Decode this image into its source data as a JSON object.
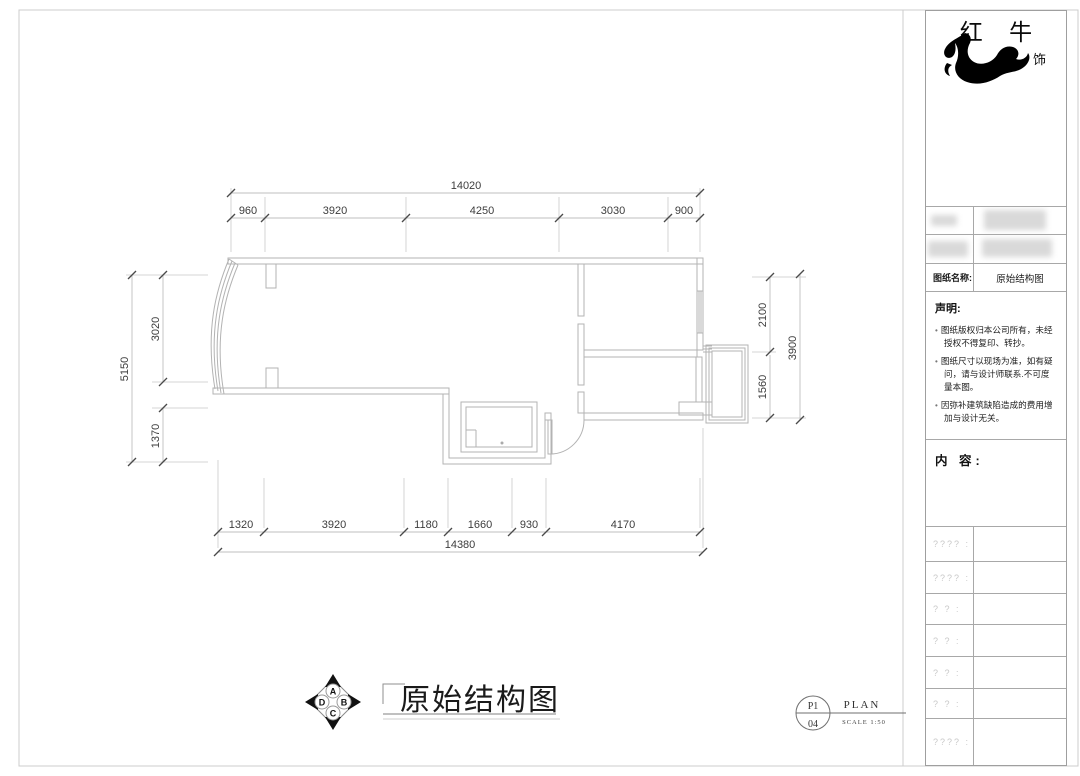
{
  "brand": {
    "name": "红 牛",
    "subtitle": "装 饰"
  },
  "title_block": {
    "drawing_name_label": "图纸名称:",
    "drawing_name_value": "原始结构图",
    "declaration_title": "声明:",
    "declaration_items": [
      "图纸版权归本公司所有，未经授权不得复印、转抄。",
      "图纸尺寸以现场为准，如有疑问，请与设计师联系.不可度量本图。",
      "因弥补建筑缺陷造成的费用增加与设计无关。"
    ],
    "content_label": "内 容:",
    "placeholder_rows": [
      "???? :",
      "???? :",
      "? ? :",
      "? ? :",
      "? ? :",
      "? ? :",
      "???? :"
    ]
  },
  "footer": {
    "drawing_title": "原始结构图",
    "compass": {
      "top": "A",
      "right": "B",
      "bottom": "C",
      "left": "D"
    },
    "sheet_no_top": "P1",
    "sheet_no_bottom": "04",
    "plan_label": "PLAN",
    "scale_label": "SCALE 1:50"
  },
  "dimensions": {
    "top_total": "14020",
    "top_chain": [
      "960",
      "3920",
      "4250",
      "3030",
      "900"
    ],
    "left_total": "5150",
    "left_chain": [
      "3020",
      "1370"
    ],
    "right_total": "3900",
    "right_chain": [
      "2100",
      "1560"
    ],
    "bottom_total": "14380",
    "bottom_chain": [
      "1320",
      "3920",
      "1180",
      "1660",
      "930",
      "4170"
    ]
  },
  "colors": {
    "wall_line": "#b3b3b3",
    "dim_line": "#bfbfbf",
    "dim_text": "#3d3d3d",
    "ink": "#1a1a1a"
  }
}
